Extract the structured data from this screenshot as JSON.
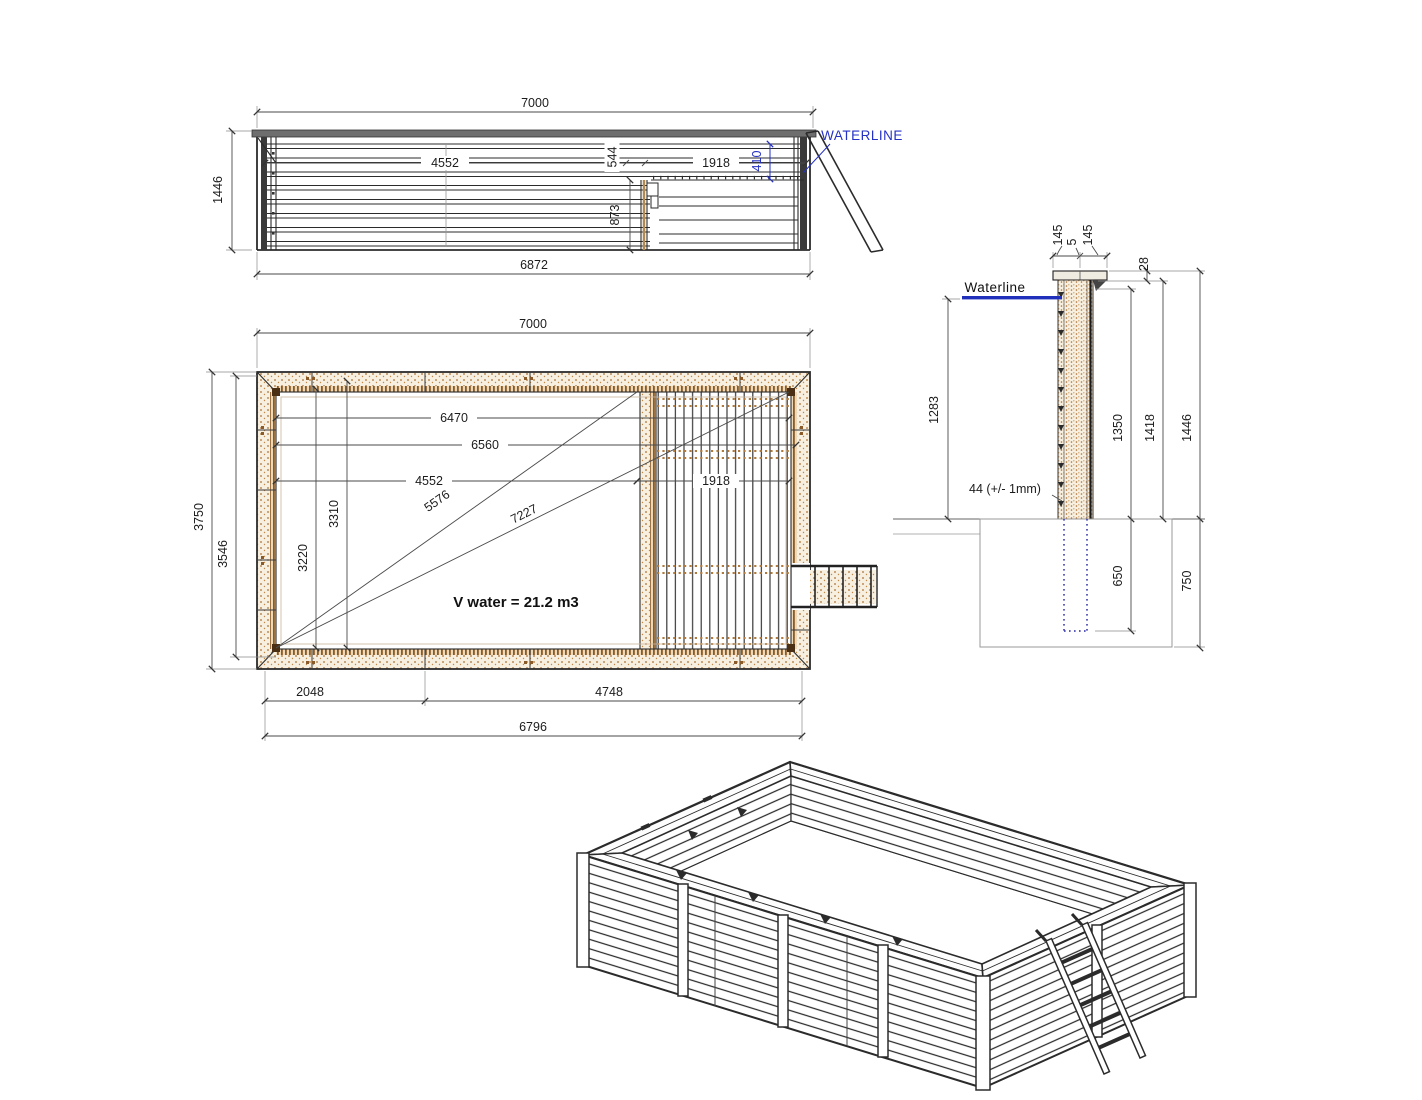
{
  "colors": {
    "ink": "#2b2b2b",
    "dimension": "#4a4a4a",
    "accent_blue": "#2431c4",
    "wood_dot": "#aa6f33",
    "wood_light": "#f7efdf"
  },
  "side_view": {
    "dims": {
      "overall_length": "7000",
      "height": "1446",
      "base_length": "6872",
      "span_left": "4552",
      "span_mid": "544",
      "span_right": "1918",
      "waterline_depth": "410",
      "bench_height": "873"
    },
    "labels": {
      "waterline": "WATERLINE"
    }
  },
  "plan_view": {
    "dims": {
      "overall_length": "7000",
      "overall_width": "3750",
      "inner_width": "3546",
      "length_6470": "6470",
      "length_6560": "6560",
      "length_4552": "4552",
      "deck_length": "1918",
      "diagonal_5576": "5576",
      "diagonal_7227": "7227",
      "width_3310": "3310",
      "width_3220": "3220",
      "segment_2048": "2048",
      "segment_4748": "4748",
      "base_length": "6796"
    },
    "labels": {
      "volume": "V water = 21.2 m3"
    }
  },
  "section_view": {
    "dims": {
      "cap_board_left": "145",
      "cap_gap": "5",
      "cap_board_right": "145",
      "cap_offset": "28",
      "waterline_to_ground": "1283",
      "height_1350": "1350",
      "height_1418": "1418",
      "height_1446": "1446",
      "wall_thickness": "44 (+/- 1mm)",
      "embed_depth": "650",
      "footing_depth": "750"
    },
    "labels": {
      "waterline": "Waterline"
    }
  }
}
